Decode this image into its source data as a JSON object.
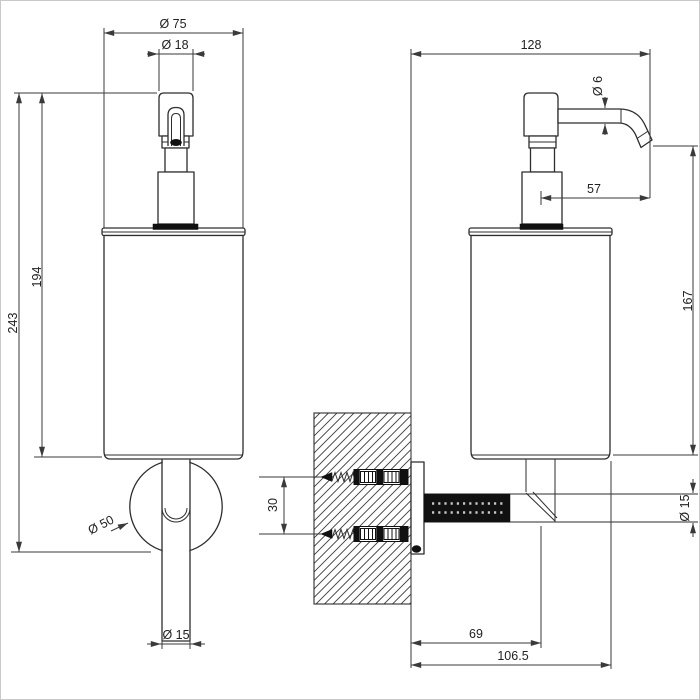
{
  "drawing": {
    "background": "#ffffff",
    "line_color": "#2d2d2d",
    "dimension_line_color": "#3a3a3a",
    "hatch_color": "#3c3c3c",
    "fill_dark": "#111111"
  },
  "dims": {
    "front": {
      "body_diameter": "Ø 75",
      "pump_neck_diameter": "Ø 18",
      "body_height": "194",
      "total_height": "243",
      "rosette_diameter": "Ø 50",
      "tube_diameter": "Ø 15"
    },
    "side": {
      "total_depth": "128",
      "spout_diameter": "Ø 6",
      "spout_projection": "57",
      "spout_to_base_height": "167",
      "screw_spacing": "30",
      "arm_diameter": "Ø 15",
      "wall_to_axis": "69",
      "wall_to_front": "106.5"
    }
  }
}
